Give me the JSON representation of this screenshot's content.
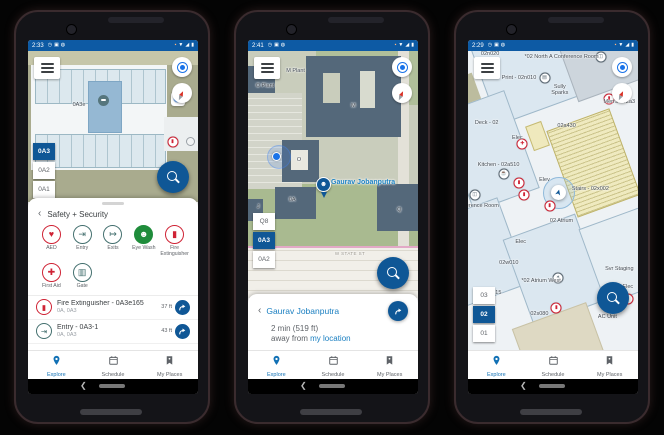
{
  "colors": {
    "status_bar": "#0d5aa4",
    "accent_blue": "#0f5796",
    "link_blue": "#1a7fc1",
    "active_nav": "#1271b5",
    "red": "#cf2335",
    "teal": "#44706f",
    "green": "#1f8c3b"
  },
  "android": {
    "back": "❮"
  },
  "status_icons": {
    "left": [
      "alarm-icon",
      "image-icon",
      "vpn-icon"
    ],
    "right": [
      "screenshot-icon",
      "wifi-icon",
      "signal-icon",
      "battery-icon"
    ]
  },
  "bottom_nav": {
    "items": [
      {
        "label": "Explore",
        "icon": "map-pin-icon"
      },
      {
        "label": "Schedule",
        "icon": "calendar-icon"
      },
      {
        "label": "My Places",
        "icon": "bookmark-icon"
      }
    ]
  },
  "phones": [
    {
      "status_time": "2:33",
      "active_nav": "Explore",
      "floor_picker": {
        "options": [
          "0A3",
          "0A2",
          "0A1"
        ],
        "selected": "0A3"
      },
      "map_labels": [
        {
          "text": "0A3e",
          "x": 30,
          "y": 34
        }
      ],
      "sheet": {
        "back_glyph": "‹",
        "title": "Safety + Security",
        "categories": [
          {
            "label": "AED",
            "icon": "aed-icon",
            "glyph": "♥",
            "style": "red-outline"
          },
          {
            "label": "Entry",
            "icon": "entry-icon",
            "glyph": "⇥",
            "style": "teal-outline"
          },
          {
            "label": "Exits",
            "icon": "exits-icon",
            "glyph": "↦",
            "style": "teal-outline"
          },
          {
            "label": "Eye Wash",
            "icon": "eye-wash-icon",
            "glyph": "☻",
            "style": "green-fill"
          },
          {
            "label": "Fire Extinguisher",
            "icon": "fire-extinguisher-icon",
            "glyph": "▮",
            "style": "red-outline"
          },
          {
            "label": "First Aid",
            "icon": "first-aid-icon",
            "glyph": "✚",
            "style": "red-outline"
          },
          {
            "label": "Gate",
            "icon": "gate-icon",
            "glyph": "▥",
            "style": "teal-outline"
          }
        ],
        "results": [
          {
            "title": "Fire Extinguisher - 0A3e165",
            "subtitle": "0A, 0A3",
            "distance": "37 ft",
            "glyph": "▮",
            "style": "red-outline"
          },
          {
            "title": "Entry - 0A3-1",
            "subtitle": "0A, 0A3",
            "distance": "43 ft",
            "glyph": "⇥",
            "style": "teal-outline"
          }
        ]
      }
    },
    {
      "status_time": "2:41",
      "active_nav": "Explore",
      "floor_picker": {
        "options": [
          "Q8",
          "0A3",
          "0A2"
        ],
        "selected": "0A3"
      },
      "map_labels": [
        {
          "text": "M Plant",
          "x": 28,
          "y": 7
        },
        {
          "text": "O Plant",
          "x": 10,
          "y": 13
        },
        {
          "text": "M",
          "x": 62,
          "y": 21
        },
        {
          "text": "O",
          "x": 30,
          "y": 43
        },
        {
          "text": "0A",
          "x": 26,
          "y": 59
        },
        {
          "text": "J",
          "x": 6,
          "y": 62
        },
        {
          "text": "Q",
          "x": 89,
          "y": 63
        },
        {
          "text": "W STATE ST",
          "x": 60,
          "y": 81,
          "cls": "street"
        }
      ],
      "person_pin": {
        "label": "Gaurav Jobanputra"
      },
      "sheet": {
        "back_glyph": "‹",
        "title": "Gaurav Jobanputra",
        "eta": "2 min (519 ft)",
        "away_prefix": "away from ",
        "location_link": "my location"
      }
    },
    {
      "status_time": "2:29",
      "active_nav": "Explore",
      "floor_picker": {
        "options": [
          "03",
          "02",
          "01"
        ],
        "selected": "02"
      },
      "map_labels": [
        {
          "text": "02n020",
          "x": 13,
          "y": 0
        },
        {
          "text": "*02 North A Conference Room",
          "x": 55,
          "y": 1
        },
        {
          "text": "Print - 02n010",
          "x": 30,
          "y": 8
        },
        {
          "text": "Sully Sparks",
          "x": 54,
          "y": 11,
          "cls": "wrap"
        },
        {
          "text": "Men's - 02a3",
          "x": 89,
          "y": 16
        },
        {
          "text": "Deck - 02",
          "x": 11,
          "y": 23
        },
        {
          "text": "Elec",
          "x": 29,
          "y": 28
        },
        {
          "text": "02a430",
          "x": 58,
          "y": 24
        },
        {
          "text": "Kitchen - 02a510",
          "x": 18,
          "y": 37
        },
        {
          "text": "Elev",
          "x": 45,
          "y": 42
        },
        {
          "text": "Stairs - 02x002",
          "x": 72,
          "y": 45
        },
        {
          "text": "02 Atrium",
          "x": 55,
          "y": 56
        },
        {
          "text": "Conference Room",
          "x": 5,
          "y": 51
        },
        {
          "text": "Elec",
          "x": 31,
          "y": 63
        },
        {
          "text": "02w010",
          "x": 24,
          "y": 70
        },
        {
          "text": "*02 Atrium West",
          "x": 43,
          "y": 76
        },
        {
          "text": "Svr Staging",
          "x": 89,
          "y": 72
        },
        {
          "text": "02w015",
          "x": 14,
          "y": 80
        },
        {
          "text": "02s080",
          "x": 42,
          "y": 87
        },
        {
          "text": "Elec",
          "x": 94,
          "y": 78
        },
        {
          "text": "AC Unit",
          "x": 82,
          "y": 88
        }
      ],
      "map_icons": [
        {
          "icon": "conference-icon",
          "x": 78,
          "y": 2
        },
        {
          "icon": "printer-icon",
          "x": 45,
          "y": 9
        },
        {
          "icon": "fire-extinguisher-icon",
          "x": 83,
          "y": 16
        },
        {
          "icon": "first-aid-icon",
          "x": 32,
          "y": 31
        },
        {
          "icon": "kitchen-icon",
          "x": 21,
          "y": 41
        },
        {
          "icon": "fire-extinguisher-icon",
          "x": 30,
          "y": 44
        },
        {
          "icon": "fire-extinguisher-icon",
          "x": 33,
          "y": 48
        },
        {
          "icon": "fire-extinguisher-icon",
          "x": 48,
          "y": 52
        },
        {
          "icon": "conference-icon",
          "x": 4,
          "y": 48
        },
        {
          "icon": "atrium-icon",
          "x": 53,
          "y": 76
        },
        {
          "icon": "fire-extinguisher-icon",
          "x": 52,
          "y": 86
        },
        {
          "icon": "fire-extinguisher-icon",
          "x": 94,
          "y": 83
        }
      ]
    }
  ]
}
